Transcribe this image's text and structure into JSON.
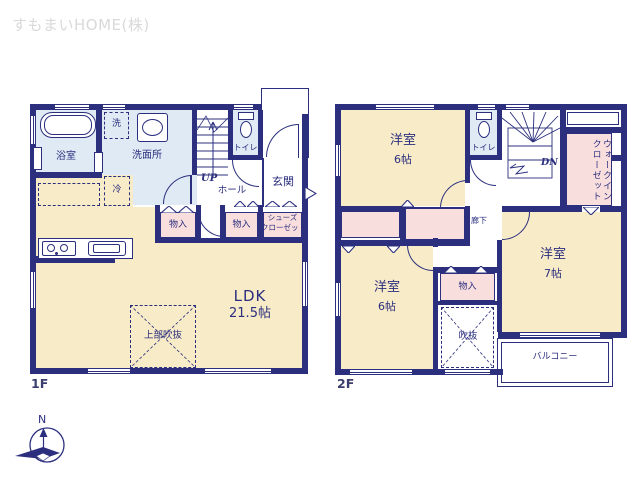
{
  "logo": {
    "text": "すもまいHOME(株)"
  },
  "compass": {
    "north_label": "N"
  },
  "floor1": {
    "floor_label": "1F",
    "labels": {
      "bathroom": "浴室",
      "washer": "洗",
      "washroom": "洗面所",
      "toilet": "トイレ",
      "stairs_up": "UP",
      "hall": "ホール",
      "entrance": "玄関",
      "fridge": "冷",
      "storage_a": "物入",
      "storage_b": "物入",
      "shoes_closet_line1": "シューズ",
      "shoes_closet_line2": "クローゼット",
      "ldk_name": "LDK",
      "ldk_size": "21.5帖",
      "open_ceiling": "上部吹抜"
    }
  },
  "floor2": {
    "floor_label": "2F",
    "labels": {
      "bedroom1_name": "洋室",
      "bedroom1_size": "6帖",
      "toilet": "トイレ",
      "stairs_down": "DN",
      "walk_in_closet": "ウォークインクローゼット",
      "corridor": "廊下",
      "bedroom2_name": "洋室",
      "bedroom2_size": "6帖",
      "storage": "物入",
      "void": "吹抜",
      "bedroom3_name": "洋室",
      "bedroom3_size": "7帖",
      "balcony": "バルコニー"
    }
  },
  "colors": {
    "wall": "#2b2f7e",
    "cream": "#f8ebc8",
    "blue": "#dfeaf4",
    "pink": "#f9dede",
    "logo": "#d9d9d9"
  }
}
